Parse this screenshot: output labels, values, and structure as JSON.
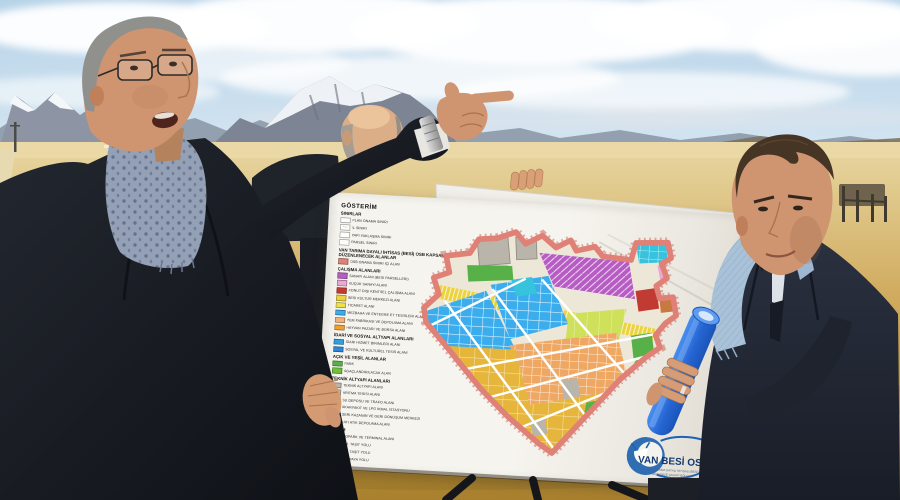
{
  "board": {
    "legend": {
      "title": "GÖSTERİM",
      "sections": [
        {
          "header": "SINIRLAR",
          "rows": [
            {
              "sw": "outline",
              "label": "PLAN ONAMA SINIRI"
            },
            {
              "sw": "dash",
              "label": "İL SINIRI"
            },
            {
              "sw": "outline",
              "label": "YAPI YAKLAŞMA SINIRI"
            },
            {
              "sw": "outline",
              "label": "PARSEL SINIRI"
            }
          ]
        },
        {
          "header": "VAN TARIMA DAYALI İHTİSAS (BESİ) OSB KAPSAMINDA DÜZENLENECEK ALANLAR",
          "rows": [
            {
              "sw": "#df8177",
              "label": "OSB ONAMA SINIRI İÇİ ALAN"
            }
          ]
        },
        {
          "header": "ÇALIŞMA ALANLARI",
          "rows": [
            {
              "sw": "#b65cc3",
              "label": "SANAYİ ALANI (BESİ PARSELLERİ)"
            },
            {
              "sw": "#eba8d4",
              "label": "KÜÇÜK SANAYİ ALANI"
            },
            {
              "sw": "#c23b32",
              "label": "KONUT DIŞI KENTSEL ÇALIŞMA ALANI"
            },
            {
              "sw": "#ecd23d",
              "label": "BESİ KÜLTÜR MERKEZİ ALANI"
            },
            {
              "sw": "#f0e04a",
              "label": "TİCARET ALANI"
            },
            {
              "sw": "#3badec",
              "label": "MEZBAHA VE ENTEGRE ET TESİSLERİ ALANI"
            },
            {
              "sw": "#f2b27e",
              "label": "YEM FABRİKASI VE DEPOLAMA ALANI"
            },
            {
              "sw": "#efa030",
              "label": "HAYVAN PAZARI VE BORSA ALANI"
            }
          ]
        },
        {
          "header": "İDARİ VE SOSYAL ALTYAPI ALANLARI",
          "rows": [
            {
              "sw": "#2f9fe0",
              "label": "İDARİ HİZMET BİRİMLERİ ALANI"
            },
            {
              "sw": "#2f86d6",
              "label": "SOSYAL VE KÜLTÜREL TESİS ALANI"
            }
          ]
        },
        {
          "header": "AÇIK VE YEŞİL ALANLAR",
          "rows": [
            {
              "sw": "#58b148",
              "label": "PARK"
            },
            {
              "sw": "#6fbf3e",
              "label": "AĞAÇLANDIRILACAK ALAN"
            }
          ]
        },
        {
          "header": "TEKNİK ALTYAPI ALANLARI",
          "rows": [
            {
              "sw": "#b9b5ab",
              "label": "TEKNİK ALTYAPI ALANI"
            },
            {
              "sw": "#c4c0b6",
              "label": "ARITMA TESİSİ ALANI"
            },
            {
              "sw": "#a94f45",
              "label": "SU DEPOSU VE TRAFO ALANI"
            },
            {
              "sw": "#c23b32",
              "label": "AKARYAKIT VE LPG İKMAL İSTASYONU"
            },
            {
              "sw": "#4f9e3c",
              "label": "GERİ KAZANIM VE GERİ DÖNÜŞÜM MERKEZİ"
            },
            {
              "sw": "#9ccc4e",
              "label": "KATI ATIK DEPOLAMA ALANI"
            }
          ]
        },
        {
          "header": "ULAŞIM",
          "rows": [
            {
              "sw": "#8e2f28",
              "label": "OTOPARK VE TERMİNAL ALANI"
            },
            {
              "sw": "#c4c0b6",
              "label": "25 M. TAŞIT YOLU"
            },
            {
              "sw": "outline",
              "label": "15 M. TAŞIT YOLU"
            },
            {
              "sw": "outline",
              "label": "10 M. YAYA YOLU"
            }
          ]
        }
      ]
    },
    "logo": {
      "name": "VAN BESİ OSB",
      "sub1": "VAN TARIMA DAYALI İHTİSAS (BESİ)",
      "sub2": "ORGANİZE SANAYİ BÖLGESİ"
    }
  },
  "map": {
    "colors": {
      "boundary": "#df8177",
      "purple": "#b65cc3",
      "pink": "#eba8d4",
      "red": "#c23b32",
      "yellow": "#ecd23d",
      "chartreuse": "#cfe05a",
      "blue": "#3badec",
      "cyan": "#37c2dd",
      "orange": "#efa863",
      "gold": "#e6b53b",
      "green": "#58b148",
      "gray": "#b9b5ab",
      "road": "#ffffff",
      "base": "#ece7d6"
    }
  },
  "palette": {
    "sky_top": "#b7d3e8",
    "sky_low": "#d9e8f3",
    "cloud": "#ffffff",
    "mountain_far": "#93a0b0",
    "mountain_near": "#7d8494",
    "snow": "#f4f7fa",
    "ridge_right": "#7a7260",
    "field_light": "#e8d7a2",
    "field_mid": "#cfa95c",
    "field_deep": "#a9812e",
    "road_dirt": "#e7d9b0",
    "board_bg": "#f5f2ec",
    "coat_left": "#1a1e26",
    "coat_right": "#252b37",
    "scarf_left": "#93a0b6",
    "scarf_right": "#a9c2d8",
    "skin": "#cf9470",
    "skin2": "#dcae88",
    "hair_gray": "#90908c",
    "hair_brown": "#463425",
    "tube_light": "#4a8ef0",
    "tube_dark": "#1b54b8",
    "easel": "#15161a",
    "logo_blue": "#1f63b0",
    "logo_text": "#123a72"
  }
}
